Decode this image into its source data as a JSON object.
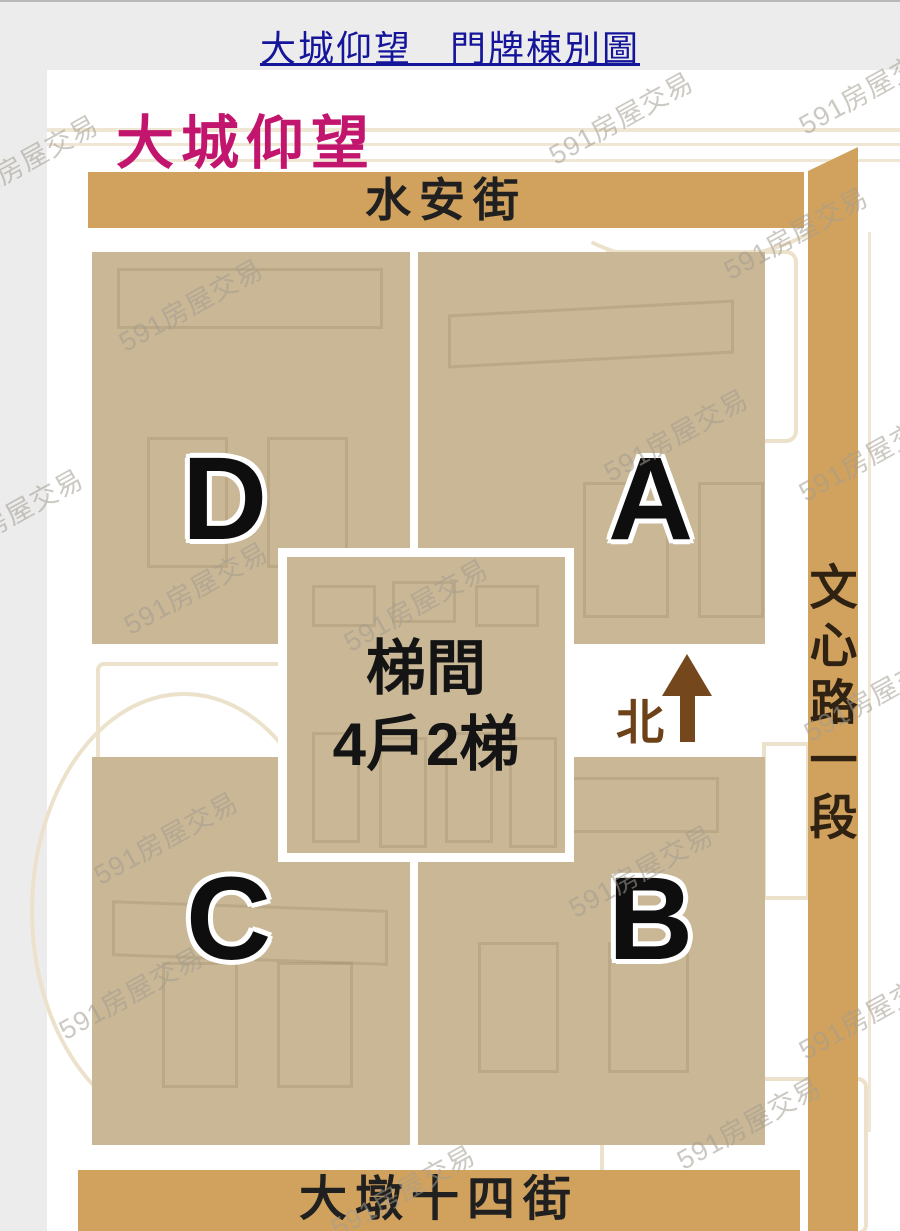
{
  "header": {
    "title": "大城仰望　門牌棟別圖"
  },
  "map": {
    "title": "大城仰望"
  },
  "streets": {
    "top": "水安街",
    "right": "文心路一段",
    "bottom": "大墩十四街"
  },
  "blocks": [
    {
      "letter": "D",
      "address": "328號-5",
      "position": "top-left"
    },
    {
      "letter": "A",
      "address": "328號-1",
      "position": "top-right"
    },
    {
      "letter": "C",
      "address": "328號-3",
      "position": "bottom-left"
    },
    {
      "letter": "B",
      "address": "328號-2",
      "position": "bottom-right"
    }
  ],
  "stairwell": {
    "line1": "梯間",
    "line2": "4戶2梯"
  },
  "compass": {
    "north_label": "北"
  },
  "watermark": {
    "text": "591房屋交易"
  },
  "colors": {
    "block_fill": "#c9b795",
    "road_fill": "#d1a25d",
    "header_title_navy": "#15159b",
    "map_title_pink": "#c2156e",
    "compass_brown": "#75471d",
    "page_background": "#ececec"
  }
}
